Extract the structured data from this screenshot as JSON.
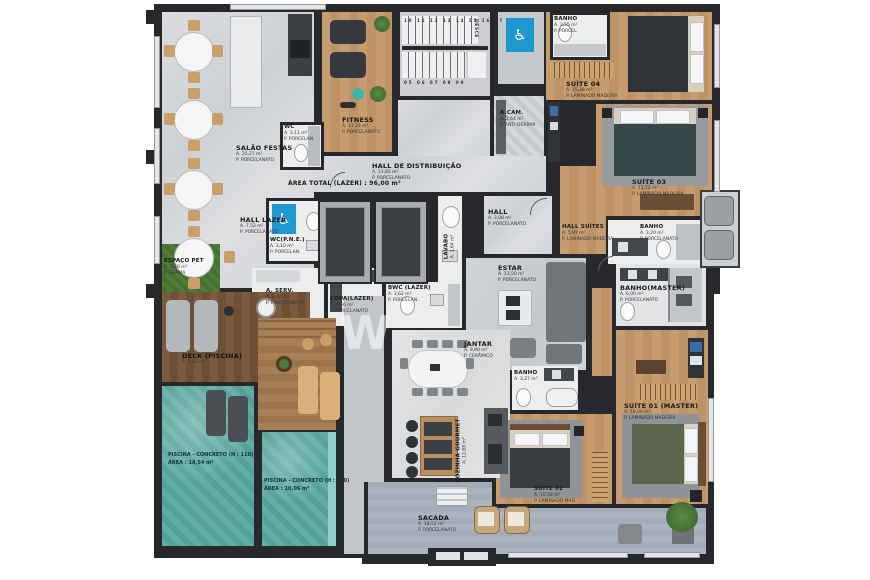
{
  "colors": {
    "wall": "#26282c",
    "accessible_blue": "#1f97cf",
    "pool": "#5aa9a1",
    "wood": "#c2976a",
    "deck": "#7b5a3d",
    "balcony": "#a9b1bc",
    "grass": "#4e7d38"
  },
  "icons": {
    "accessible": "♿"
  },
  "rooms": {
    "salao_festas": {
      "name": "SALÃO FESTAS",
      "area": "A. 25,27 m²",
      "floor": "P. PORCELANATO"
    },
    "wc_lazer": {
      "name": "WC",
      "area": "A. 3,11 m²",
      "floor": "P. PORCELAN."
    },
    "fitness": {
      "name": "FITNESS",
      "area": "A. 13,35 m²",
      "floor": "P. PORCELANATO"
    },
    "hall_distribuicao": {
      "name": "HALL DE DISTRIBUIÇÃO",
      "area": "A. 13,85 m²",
      "floor": "P. PORCELANATO"
    },
    "hall_lazer": {
      "name": "HALL LAZER",
      "area": "A. 7,52 m²",
      "floor": "P. PORCELANATO"
    },
    "wc_pne": {
      "name": "WC(P.N.E.)",
      "area": "A. 3,10 m²",
      "floor": "P. PORCELAN."
    },
    "espaco_pet": {
      "name": "ESPAÇO PET",
      "area": "A. 3,50 m²",
      "floor": "P. GRAMA"
    },
    "a_serv": {
      "name": "A. SERV.",
      "area": "A. 3,40 m²",
      "floor": "P. PORCELANATO"
    },
    "copa_lazer": {
      "name": "COPA(LAZER)",
      "area": "A. 4,56 m²",
      "floor": "P. PORCELANATO"
    },
    "bwc_lazer": {
      "name": "BWC (LAZER)",
      "area": "A. 3,62 m²",
      "floor": "P. PORCELAN."
    },
    "deck_piscina": {
      "name": "DECK (PISCINA)",
      "area": "A. 7,92 m²"
    },
    "banho_topo": {
      "name": "BANHO",
      "area": "A. 3,55 m²",
      "floor": "P. PORCEL."
    },
    "suite_04": {
      "name": "SUÍTE 04",
      "area": "A. 15,38 m²",
      "floor": "P. LAMINADO MADEIRA"
    },
    "a_cam": {
      "name": "A.CAM.",
      "area": "A. 2,64 m²",
      "floor": "P. ANTI-DERRAP."
    },
    "suite_03": {
      "name": "SUÍTE 03",
      "area": "A. 11,72 m²",
      "floor": "P. LAMINADO MADEIRA"
    },
    "banho_03": {
      "name": "BANHO",
      "area": "A. 3,20 m²",
      "floor": "P. PORCELANATO"
    },
    "hall_suites": {
      "name": "HALL SUÍTES",
      "area": "A. 5,97 m²",
      "floor": "P. LAMINADO MADEIRA"
    },
    "lavabo": {
      "name": "LAVABO",
      "area": "A. 2,64 m²",
      "floor": "P. PORCELANATO"
    },
    "hall": {
      "name": "HALL",
      "area": "A. 3,08 m²",
      "floor": "P. PORCELANATO"
    },
    "estar": {
      "name": "ESTAR",
      "area": "A. 13,50 m²",
      "floor": "P. PORCELANATO"
    },
    "jantar": {
      "name": "JANTAR",
      "area": "A. 9,90 m²",
      "floor": "P. CERÂMICO"
    },
    "cozinha_gourmet": {
      "name": "COZINHA GOURMET",
      "area": "A. 12,88 m²",
      "floor": "P. PORCELANATO"
    },
    "banho_02": {
      "name": "BANHO",
      "area": "A. 3,27 m²",
      "floor": "P. PORCELAN."
    },
    "suite_02": {
      "name": "SUÍTE 02",
      "area": "A. 10,58 m²",
      "floor": "P. LAMINADO MAD."
    },
    "suite_01": {
      "name": "SUÍTE 01 (MASTER)",
      "area": "A. 18,00 m²",
      "floor": "P. LAMINADO MADEIRA"
    },
    "banho_master": {
      "name": "BANHO(MASTER)",
      "area": "A. 6,00 m²",
      "floor": "P. PORCELANATO"
    },
    "sacada": {
      "name": "SACADA",
      "area": "A. 18,52 m²",
      "floor": "P. PORCELANATO"
    }
  },
  "pools": {
    "left": {
      "line1": "PISCINA - CONCRETO (H : 110)",
      "line2": "ÁREA : 18,54 m²"
    },
    "right": {
      "line1": "PISCINA - CONCRETO (H : 120)",
      "line2": "ÁREA : 10,06 m²"
    }
  },
  "annotations": {
    "area_total_lazer": "ÁREA TOTAL (LAZER) : 96,00 m²",
    "stairs_down": "DESCE",
    "steps_upper": "10 11 12 13 14 15 16 17 18 19",
    "steps_lower": "05 06 07 08 09",
    "watermark": "W"
  }
}
